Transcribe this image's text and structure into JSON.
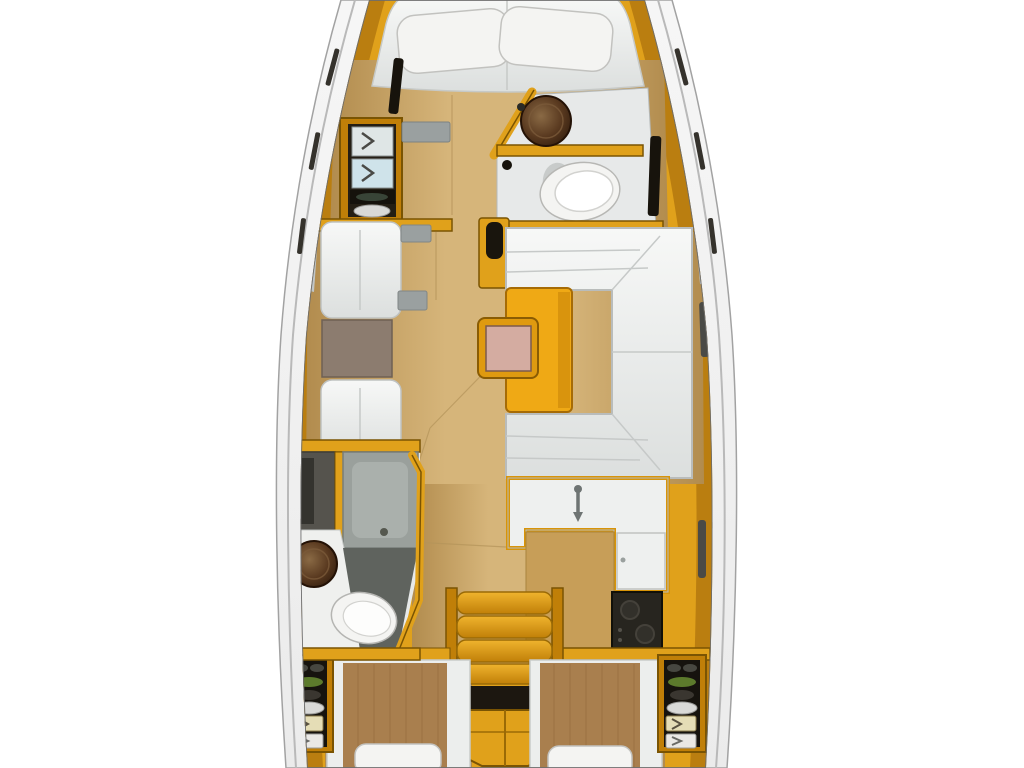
{
  "canvas": {
    "width": 1024,
    "height": 768,
    "background": "#ffffff"
  },
  "diagram": {
    "type": "boat-interior-floor-plan",
    "view": "top-down",
    "regions": [
      {
        "id": "v-berth",
        "desc": "forward double berth with two pillows"
      },
      {
        "id": "forward-cabin",
        "desc": "forward cabin with port wardrobe shelves"
      },
      {
        "id": "forward-head",
        "desc": "forward bathroom with round sink and toilet"
      },
      {
        "id": "salon",
        "desc": "main salon"
      },
      {
        "id": "port-settees",
        "desc": "two facing seats with small table"
      },
      {
        "id": "starboard-u-settee",
        "desc": "U shaped dinette settee"
      },
      {
        "id": "salon-table",
        "desc": "dinette table with folding leaf"
      },
      {
        "id": "aft-head",
        "desc": "aft bathroom with shower, sink and toilet"
      },
      {
        "id": "galley",
        "desc": "L shaped galley with sink, fridge and stove"
      },
      {
        "id": "companionway",
        "desc": "entry steps and cabinet"
      },
      {
        "id": "aft-cabin-port",
        "desc": "port aft double cabin"
      },
      {
        "id": "aft-cabin-starboard",
        "desc": "starboard aft double cabin"
      }
    ]
  },
  "palette": {
    "hullBand": "#ebebeb",
    "hullBandLight": "#f6f6f6",
    "hullLine": "#a2a2a2",
    "hullInnerLine": "#6d6d6d",
    "joinery": "#e0a11b",
    "joineryLight": "#f0b42e",
    "joineryDark": "#c07f08",
    "joineryEdge": "#7a5403",
    "woodLight": "#d6b57a",
    "woodMid": "#c9a468",
    "woodDark": "#b28c4e",
    "galleyWood": "#c79e58",
    "cushion": "#eff1f0",
    "cushionHi": "#f7f8f7",
    "cushionLo": "#dcdfde",
    "cushionLine": "#c2c5c4",
    "headFloor": "#e7e9e9",
    "showerGray": "#9aa09c",
    "showerTray": "#aab0ac",
    "lockerGray": "#55534d",
    "bathFloorGray": "#5f635e",
    "sinkDark": "#2e1a0c",
    "sinkMid": "#5a3a20",
    "sinkLight": "#8a6a45",
    "toilet": "#f4f4f2",
    "tableOrange": "#efa915",
    "tableShade": "#c78307",
    "extFrame": "#df9a10",
    "extTop": "#d4aca1",
    "brownTable": "#8c7c6f",
    "stove": "#27251f",
    "burner": "#44413a",
    "blanket": "#a97f4e",
    "blanketLine": "#8f6838",
    "plant": "#5c7a2c",
    "plate": "#d9d9d7",
    "drawerCream": "#e5ddb6",
    "drawerWhite": "#eae8e5",
    "darkSlot": "#35322c",
    "voidDark": "#1c1710",
    "grayFitting": "#9aa0a0",
    "interiorDark": "#17130c"
  }
}
